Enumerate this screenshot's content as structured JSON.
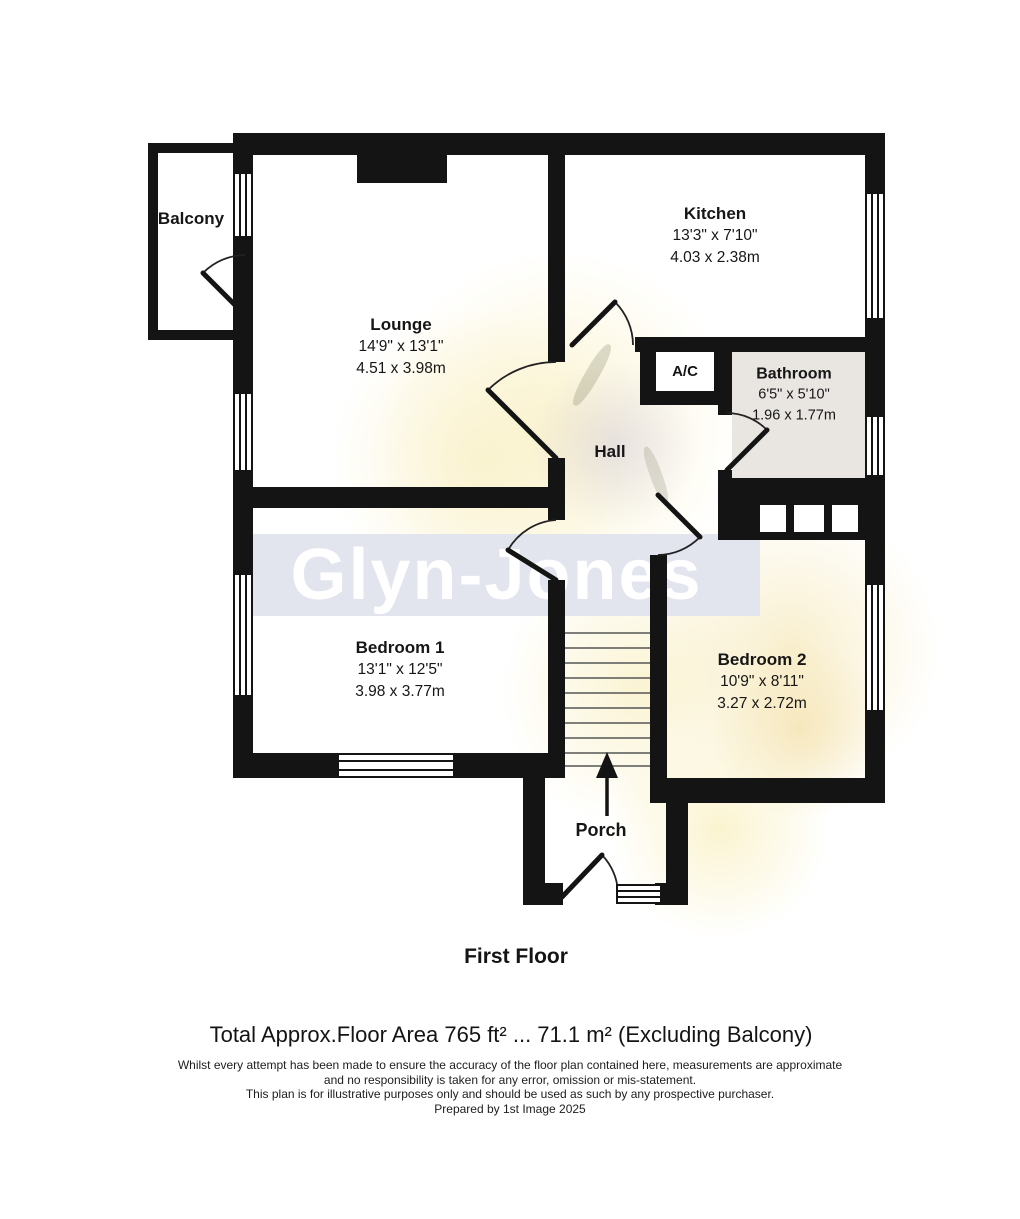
{
  "watermark": {
    "logo": "Glyn-Jones"
  },
  "rooms": [
    {
      "name": "Balcony"
    },
    {
      "name": "Lounge",
      "dims_ft": "14'9\" x 13'1\"",
      "dims_m": "4.51 x 3.98m"
    },
    {
      "name": "Kitchen",
      "dims_ft": "13'3\" x 7'10\"",
      "dims_m": "4.03 x 2.38m"
    },
    {
      "name": "A/C"
    },
    {
      "name": "Bathroom",
      "dims_ft": "6'5\" x 5'10\"",
      "dims_m": "1.96 x 1.77m"
    },
    {
      "name": "Hall"
    },
    {
      "name": "Bedroom 1",
      "dims_ft": "13'1\" x 12'5\"",
      "dims_m": "3.98 x 3.77m"
    },
    {
      "name": "Bedroom 2",
      "dims_ft": "10'9\" x 8'11\"",
      "dims_m": "3.27 x 2.72m"
    },
    {
      "name": "Porch"
    }
  ],
  "floor_label": "First Floor",
  "area_summary": "Total Approx.Floor Area 765 ft² ... 71.1 m² (Excluding Balcony)",
  "disclaimer": [
    "Whilst every attempt has been made to ensure the accuracy of the floor plan contained here, measurements are approximate",
    "and no responsibility is taken for any error, omission or mis-statement.",
    "This plan is for illustrative purposes only and should be used as such by any prospective purchaser.",
    "Prepared by 1st Image 2025"
  ],
  "colors": {
    "wall": "#141414",
    "bathroom_fill": "#e9e6e2",
    "watermark_band": "#e2e4ee",
    "watermark_logo": "#ffffff",
    "sunflower_tint": "#faf3d0",
    "text": "#161616"
  }
}
